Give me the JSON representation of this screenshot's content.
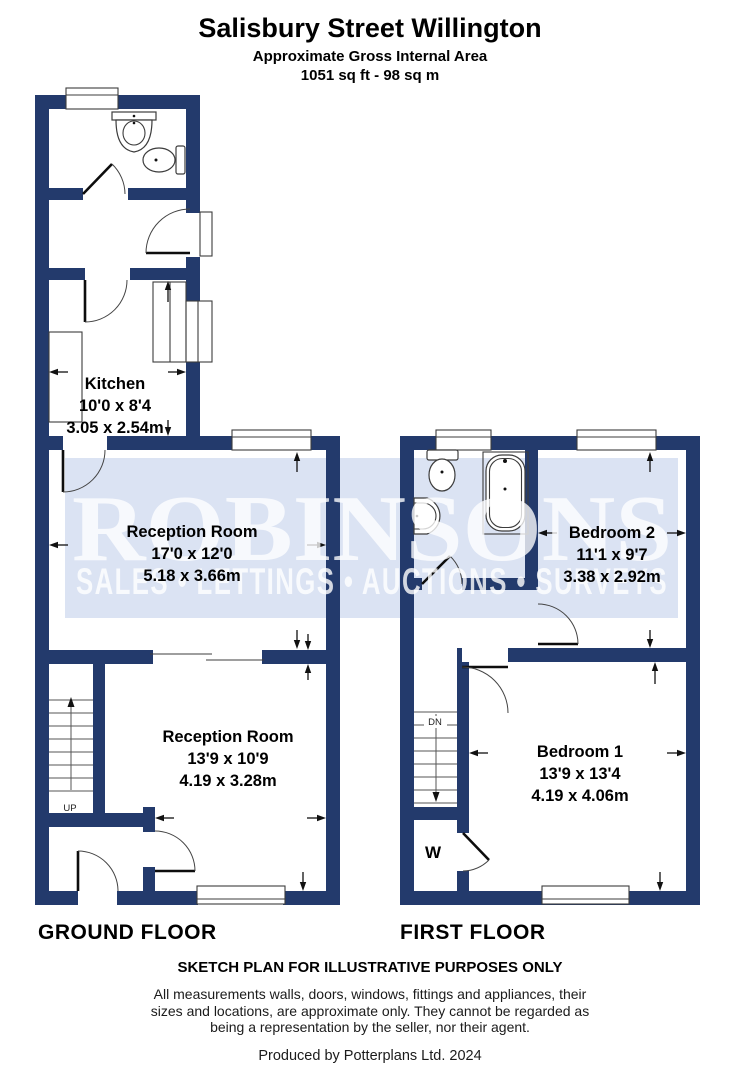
{
  "header": {
    "title": "Salisbury Street Willington",
    "subtitle": "Approximate Gross Internal Area",
    "area": "1051 sq ft - 98 sq m"
  },
  "watermark": {
    "brand": "ROBINSONS",
    "tagline": "SALES • LETTINGS • AUCTIONS • SURVEYS"
  },
  "colors": {
    "wall": "#233a6c",
    "watermark_band": "#dbe3f3",
    "watermark_text": "#ffffff"
  },
  "ground_floor": {
    "label": "GROUND FLOOR",
    "rooms": [
      {
        "name": "Kitchen",
        "imperial": "10'0 x 8'4",
        "metric": "3.05 x 2.54m"
      },
      {
        "name": "Reception Room",
        "imperial": "17'0 x 12'0",
        "metric": "5.18 x 3.66m"
      },
      {
        "name": "Reception Room",
        "imperial": "13'9 x 10'9",
        "metric": "4.19 x 3.28m"
      }
    ],
    "stair_label": "UP"
  },
  "first_floor": {
    "label": "FIRST FLOOR",
    "rooms": [
      {
        "name": "Bedroom 2",
        "imperial": "11'1 x 9'7",
        "metric": "3.38 x 2.92m"
      },
      {
        "name": "Bedroom 1",
        "imperial": "13'9 x 13'4",
        "metric": "4.19 x 4.06m"
      }
    ],
    "stair_label": "DN",
    "wardrobe_label": "W"
  },
  "footer": {
    "disclaimer": "SKETCH PLAN FOR ILLUSTRATIVE PURPOSES ONLY",
    "fine_print_lines": [
      "All measurements walls, doors, windows, fittings and appliances, their",
      "sizes and locations, are approximate only. They cannot be regarded as",
      "being a representation by the seller, nor their agent."
    ],
    "produced_by": "Produced by Potterplans Ltd. 2024"
  }
}
